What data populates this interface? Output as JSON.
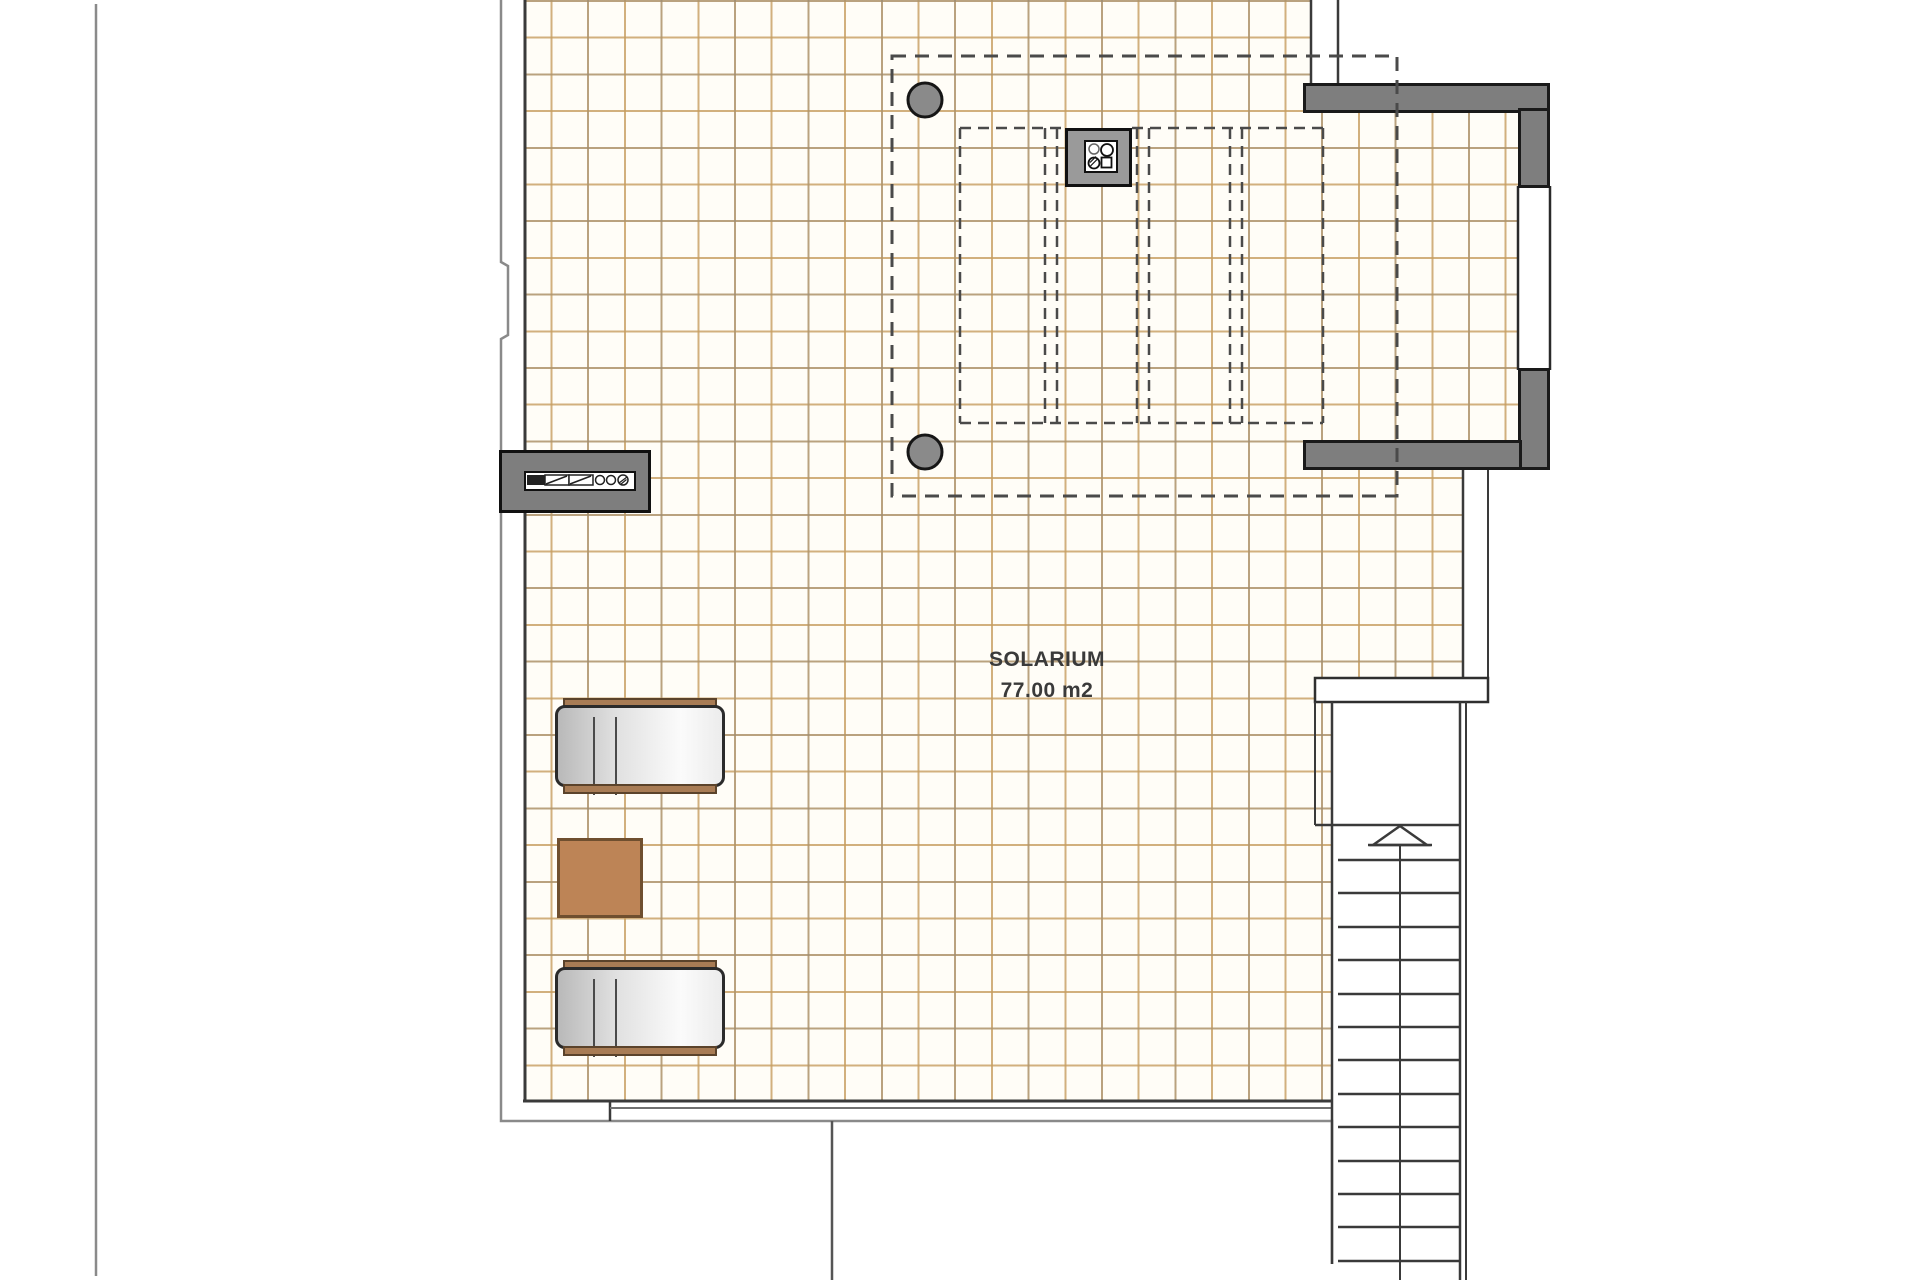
{
  "plan": {
    "room_label": "SOLARIUM",
    "room_area": "77.00 m2"
  },
  "colors": {
    "tile_line": "#c69d5f",
    "tile_major_line": "#828282",
    "floor_background": "#fffdf7",
    "wall_gray": "#7e7e7e",
    "wall_outline": "#1a1a1a",
    "pergola_dash": "#4a4a4a",
    "post_fill": "#8a8a8a",
    "boundary_gray": "#8a8a8a",
    "stair_line": "#3a3a3a",
    "lounger_rail_brown": "#a87c55",
    "table_brown": "#bd8456",
    "label_color": "#3a3a3a"
  }
}
